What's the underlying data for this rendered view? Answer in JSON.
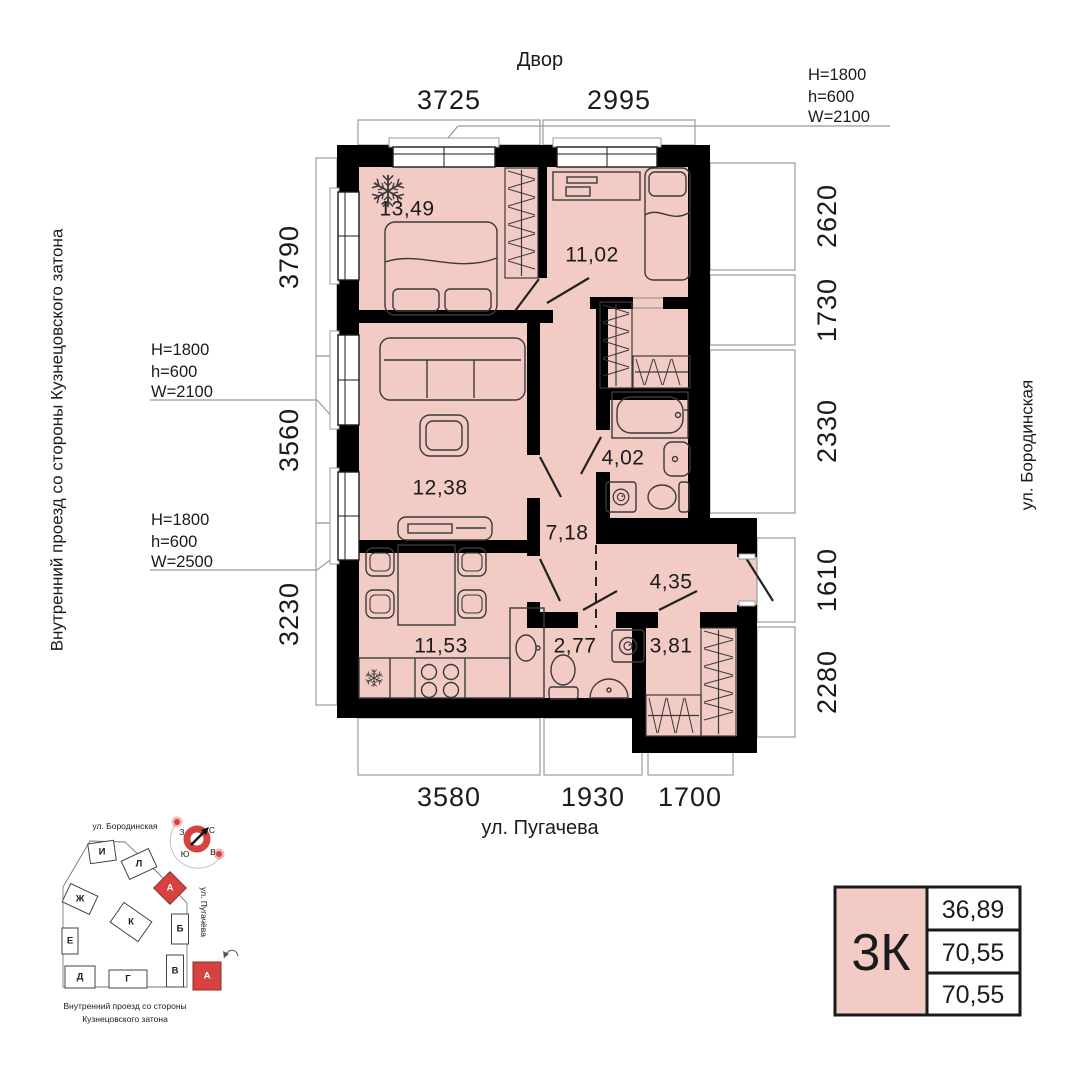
{
  "colors": {
    "floor_pink": "#f3cbc5",
    "accent_red": "#d6433e",
    "wall_black": "#000000",
    "line_gray": "#9b9b9b"
  },
  "labels": {
    "top_street": "Двор",
    "bottom_street": "ул. Пугачева",
    "left_street": "Внутренний проезд со стороны Кузнецовского затона",
    "right_street": "ул. Бородинская"
  },
  "dims": {
    "top": [
      "3725",
      "2995"
    ],
    "left": [
      "3790",
      "3560",
      "3230"
    ],
    "right": [
      "2620",
      "1730",
      "2330",
      "1610",
      "2280"
    ],
    "bottom": [
      "3580",
      "1930",
      "1700"
    ]
  },
  "specs": {
    "top_right": [
      "H=1800",
      "h=600",
      "W=2100"
    ],
    "left_upper": [
      "H=1800",
      "h=600",
      "W=2100"
    ],
    "left_lower": [
      "H=1800",
      "h=600",
      "W=2500"
    ]
  },
  "rooms": {
    "bedroom1": "13,49",
    "bedroom2": "11,02",
    "living": "12,38",
    "bathroom": "4,02",
    "hall": "7,18",
    "entry": "4,35",
    "kitchen": "11,53",
    "wc": "2,77",
    "wardrobe": "3,81"
  },
  "site": {
    "street_top": "ул. Бородинская",
    "street_right": "ул. Пугачёва",
    "caption1": "Внутренний проезд со стороны",
    "caption2": "Кузнецовского затона",
    "compass": {
      "n": "С",
      "s": "Ю",
      "w": "З",
      "e": "В"
    },
    "buildings": [
      "И",
      "Л",
      "А",
      "Ж",
      "К",
      "Б",
      "Е",
      "В",
      "Д",
      "Г"
    ],
    "legend": "А"
  },
  "card": {
    "type": "3К",
    "v1": "36,89",
    "v2": "70,55",
    "v3": "70,55"
  }
}
